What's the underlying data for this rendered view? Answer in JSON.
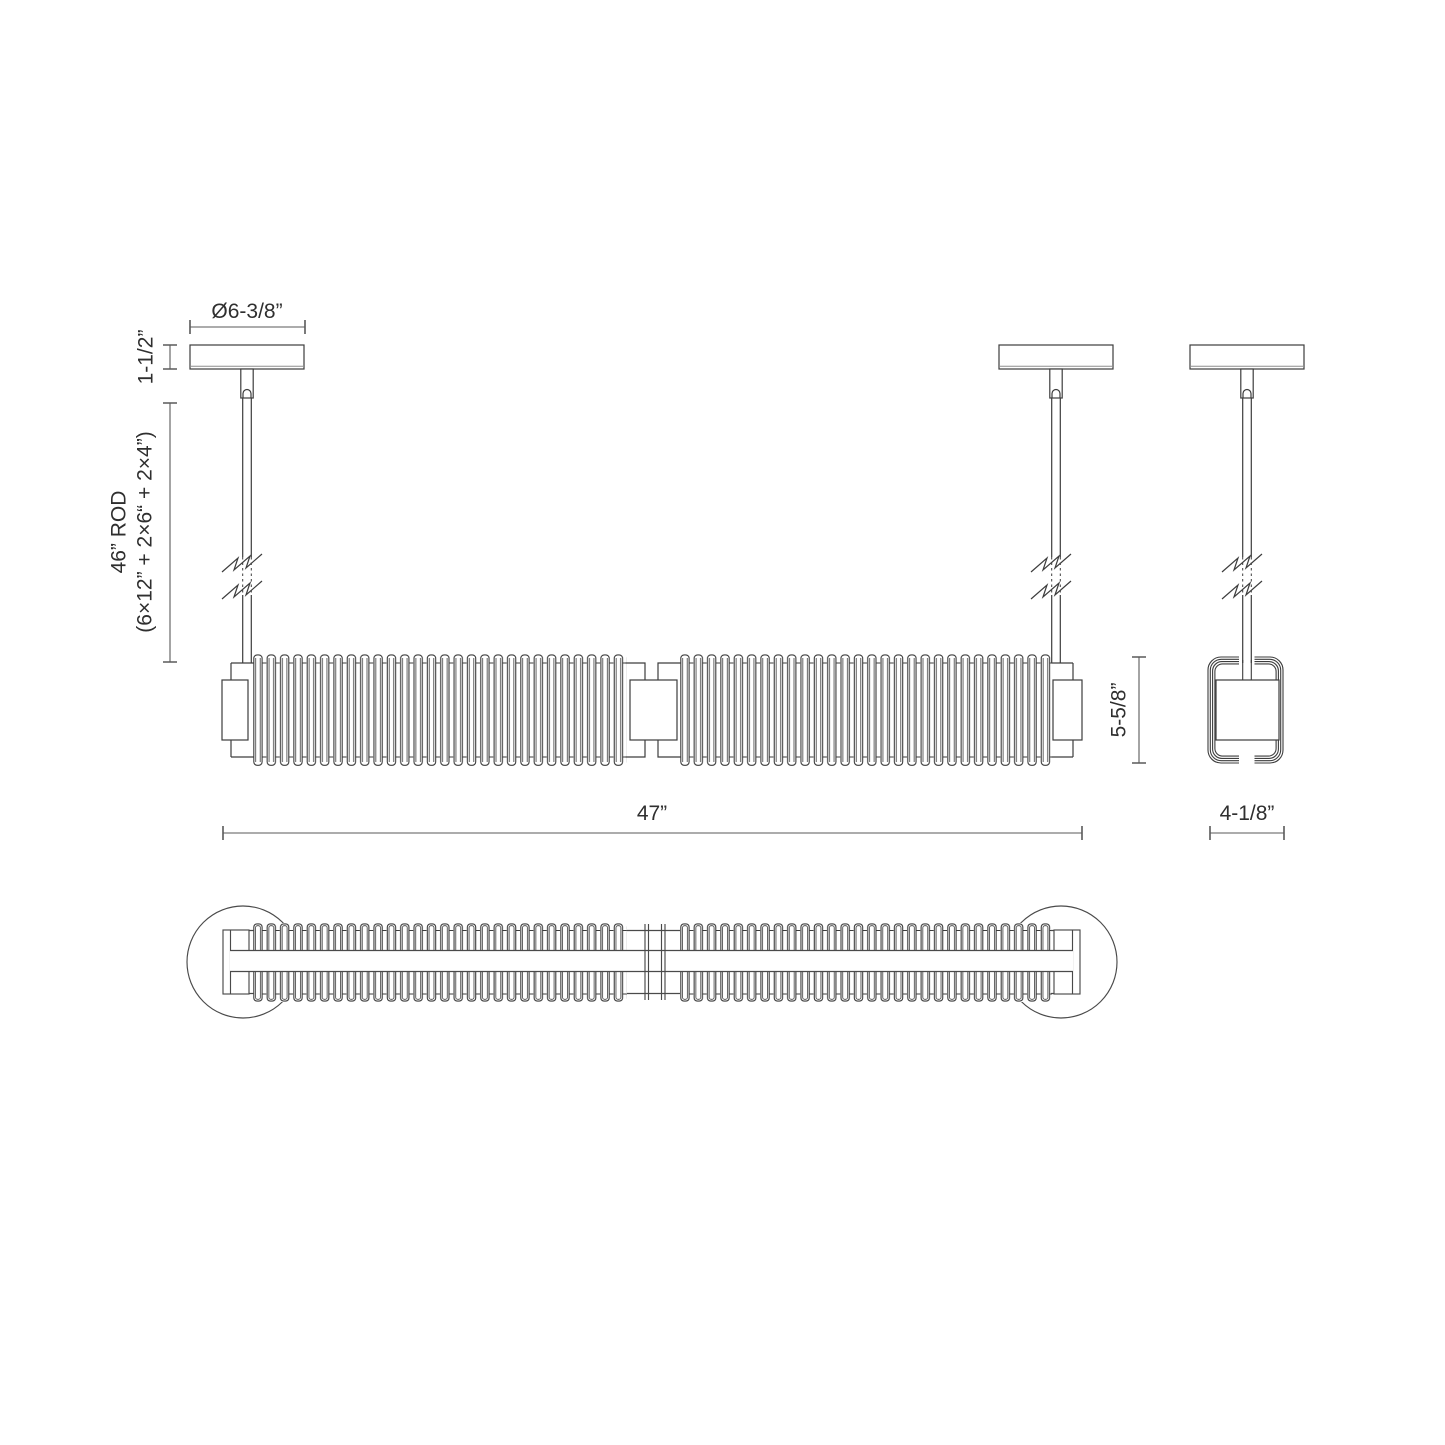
{
  "title": "Linear pendant luminaire — dimension drawing (3 views)",
  "views": {
    "front_label": "front-elevation",
    "end_label": "end-elevation",
    "plan_label": "bottom-plan"
  },
  "dimensions": {
    "canopy_diameter": "Ø6-3/8”",
    "canopy_height": "1-1/2”",
    "rod_line1": "46” ROD",
    "rod_line2": "(6×12” + 2×6“ + 2×4”)",
    "overall_length": "47”",
    "body_height": "5-5/8”",
    "body_depth": "4-1/8”"
  },
  "colors": {
    "line": "#3d3d3d",
    "dimension": "#5a5a5a",
    "text": "#2f2f2f",
    "background": "#ffffff"
  }
}
